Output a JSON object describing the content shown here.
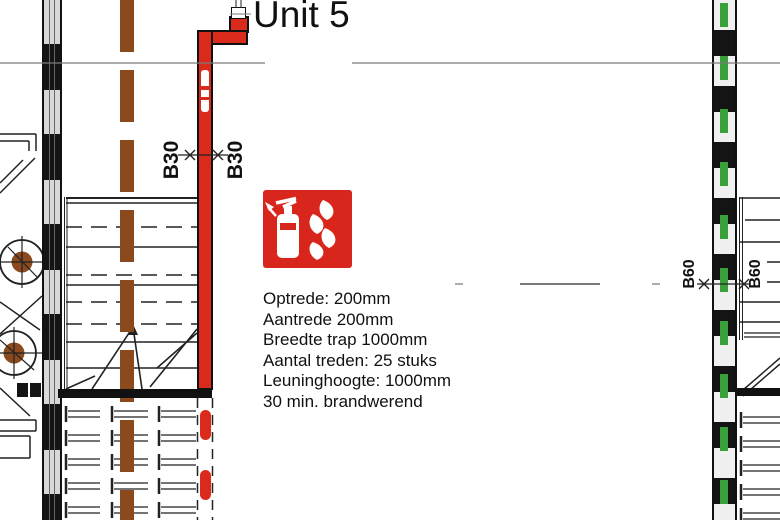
{
  "title": {
    "unit_label": "Unit 5"
  },
  "dimensions": {
    "b30_left": "B30",
    "b30_right": "B30",
    "b60_left": "B60",
    "b60_right": "B60"
  },
  "stair_specs": {
    "lines": [
      "Optrede: 200mm",
      "Aantrede 200mm",
      "Breedte trap 1000mm",
      "Aantal treden: 25 stuks",
      "Leuninghoogte: 1000mm",
      "30 min. brandwerend"
    ]
  },
  "icons": {
    "fire_extinguisher_sign": "fire-extinguisher-icon"
  },
  "colors": {
    "wall_fire_red": "#da2a1c",
    "sign_red": "#d9261c",
    "beam_brown": "#8a4a1d",
    "insulation_green": "#3aa03a",
    "line_dark": "#222222",
    "grid_gray": "#7a7a7a"
  }
}
